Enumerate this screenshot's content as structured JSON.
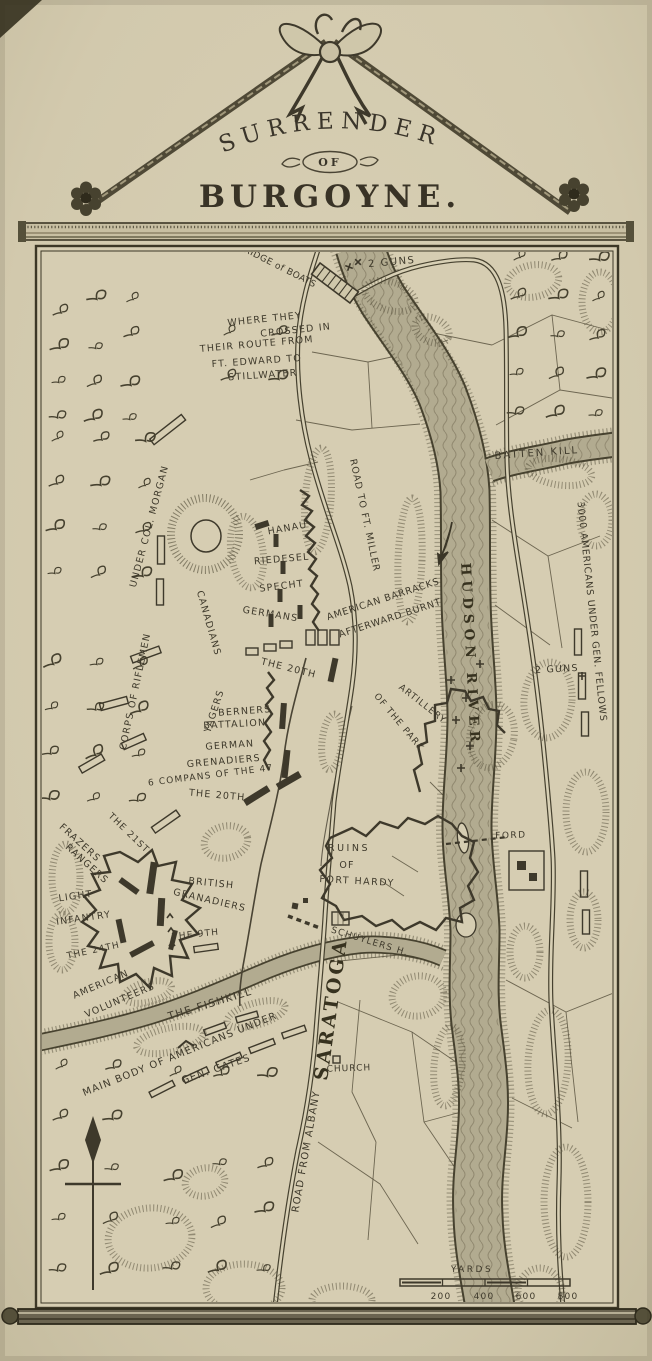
{
  "title": {
    "surrender": "SURRENDER",
    "of": "OF",
    "burgoyne": "BURGOYNE."
  },
  "labels": {
    "bridge_of_boats": "BRIDGE of BOATS",
    "guns_top": "2 GUNS",
    "guns_right": "2 GUNS",
    "crossed_1": "WHERE THEY",
    "crossed_2": "CROSSED IN",
    "crossed_3": "THEIR ROUTE FROM",
    "crossed_4": "FT. EDWARD TO",
    "crossed_5": "STILLWATER",
    "batten_kill": "BATTEN KILL",
    "fellows": "3000 AMERICANS UNDER GEN. FELLOWS",
    "road_ft_miller": "ROAD TO FT. MILLER",
    "morgan_1": "CORPS OF RIFLEMEN",
    "morgan_2": "UNDER COL. MORGAN",
    "canadians": "CANADIANS",
    "hanau": "HANAU",
    "riedesel": "RIEDESEL",
    "specht": "SPECHT",
    "germans": "GERMANS",
    "barracks_1": "AMERICAN BARRACKS",
    "barracks_2": "AFTERWARD BURNT",
    "hudson_river": "HUDSON RIVER",
    "the_20th_a": "THE 20TH",
    "the_20th_b": "THE 20TH",
    "yagers": "YAGERS",
    "berners_1": "BERNERS",
    "berners_2": "BATTALION",
    "german_grenadiers_1": "GERMAN",
    "german_grenadiers_2": "GRENADIERS",
    "companies_47th": "6 COMPANS OF THE 47",
    "artillery_1": "ARTILLERY",
    "artillery_2": "OF THE PARK",
    "the_21st": "THE 21ST",
    "frazers_1": "FRAZERS",
    "frazers_2": "RANGERS",
    "light_infantry_1": "LIGHT",
    "light_infantry_2": "INFANTRY",
    "the_24th": "THE 24TH",
    "british_1": "BRITISH",
    "british_2": "GRANADIERS",
    "the_9th": "THE 9TH",
    "american_volunteers_1": "AMERICAN",
    "american_volunteers_2": "VOLUNTEERS",
    "ruins_1": "RUINS",
    "ruins_2": "OF",
    "ruins_3": "FORT HARDY",
    "ford": "FORD",
    "schuylers_house": "SCHUYLERS H.",
    "saratoga": "SARATOGA",
    "church": "CHURCH",
    "fishkill": "THE FISHKILL",
    "main_body_1": "MAIN BODY OF AMERICANS UNDER",
    "main_body_2": "GEN. GATES",
    "road_from_albany": "ROAD FROM ALBANY"
  },
  "scale": {
    "label": "YARDS",
    "ticks": [
      "200",
      "400",
      "600",
      "800"
    ]
  },
  "colors": {
    "paper": "#d2c9ad",
    "ink": "#3e392b",
    "river": "#b2ab90"
  }
}
